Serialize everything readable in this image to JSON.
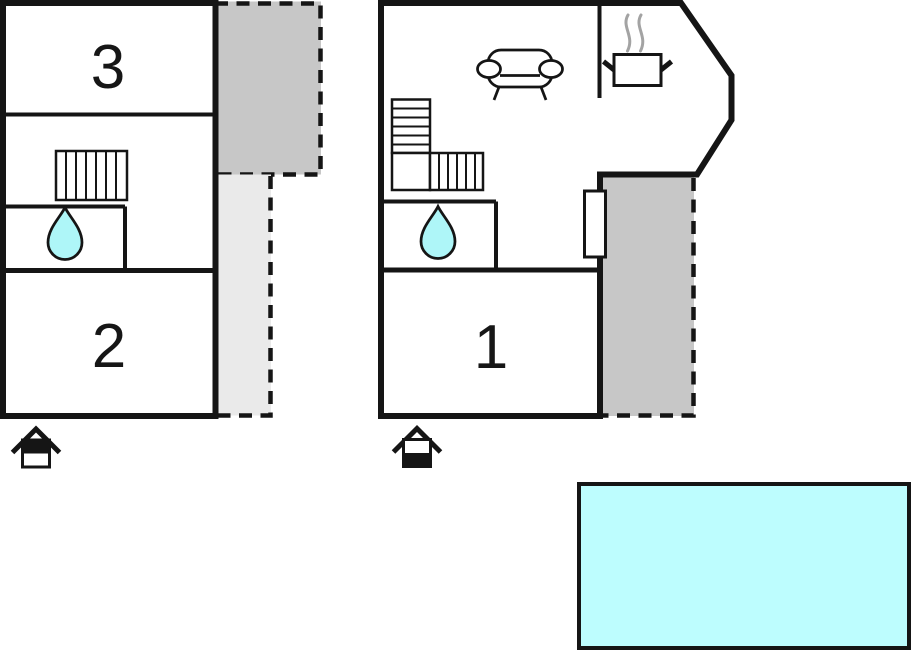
{
  "colors": {
    "wall": "#151515",
    "terrace-dark": "#c7c7c7",
    "terrace-light": "#eaeaea",
    "water": "#aef6f8",
    "pool": "#bdfdfe",
    "steam": "#a3a3a3"
  },
  "plan": {
    "units": [
      {
        "name": "left-unit",
        "rooms": [
          {
            "label": "3"
          },
          {
            "label": "2"
          }
        ],
        "icons": [
          "staircase-icon",
          "water-drop-icon",
          "entrance-arrow-icon"
        ],
        "areas": [
          "terrace-dark",
          "terrace-light"
        ]
      },
      {
        "name": "right-unit",
        "rooms": [
          {
            "label": "1"
          }
        ],
        "icons": [
          "staircase-icon",
          "water-drop-icon",
          "sofa-icon",
          "stove-pot-icon",
          "steam-icon",
          "door",
          "entrance-arrow-icon"
        ],
        "areas": [
          "terrace-dark"
        ]
      }
    ],
    "pool": {
      "type": "swimming-pool"
    }
  }
}
